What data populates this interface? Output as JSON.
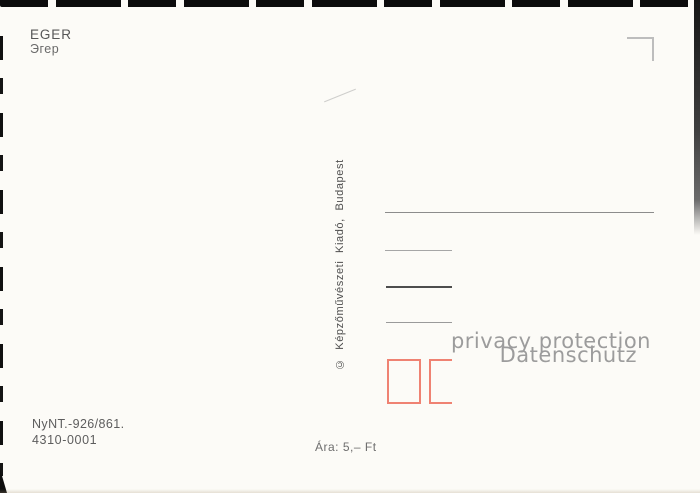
{
  "postcard": {
    "title": "EGER",
    "title_translit": "Эгер",
    "publisher_imprint": "© Képzőművészeti Kiadó, Budapest",
    "print_number": "NyNT.-926/861.",
    "order_number": "4310-0001",
    "price": "Ára: 5,– Ft"
  },
  "watermark": {
    "line1": "privacy protection",
    "line2": "Datenschutz"
  },
  "colors": {
    "postal_box_red": "#ef8272",
    "ink_gray": "#585858",
    "address_line_gray": "#8c8c8c",
    "address_line_dark": "#4d4d4d",
    "stamp_corner_gray": "#bdbdbd",
    "watermark_gray": "#9c9c9c",
    "card_background": "#fcfbf7",
    "torn_edge_black": "#0c0c0c"
  }
}
